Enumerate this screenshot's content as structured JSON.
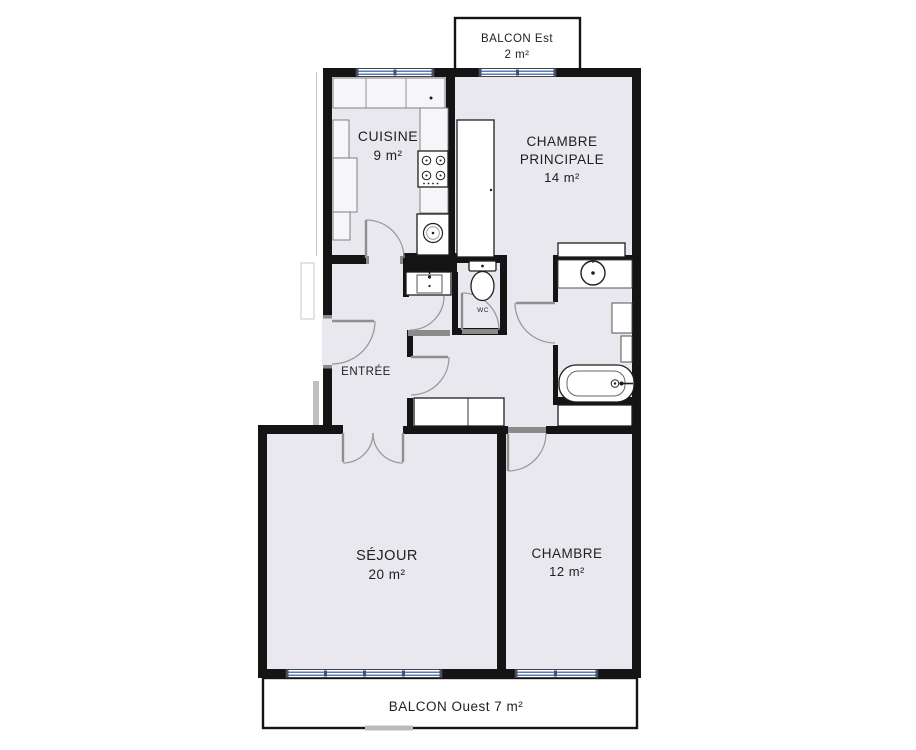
{
  "colors": {
    "background": "#ffffff",
    "room_fill": "#e8e8ee",
    "wall": "#141414",
    "window_accent": "#5b79b4",
    "door_arc": "#9a9a9a",
    "label_text": "#1f1f1f"
  },
  "rooms": {
    "balcony_east": {
      "name": "BALCON Est",
      "area": "2 m²"
    },
    "kitchen": {
      "name": "CUISINE",
      "area": "9 m²"
    },
    "master_bedroom": {
      "name_line1": "CHAMBRE",
      "name_line2": "PRINCIPALE",
      "area": "14 m²"
    },
    "entry": {
      "name": "ENTRÉE"
    },
    "toilet": {
      "name": "WC"
    },
    "living_room": {
      "name": "SÉJOUR",
      "area": "20 m²"
    },
    "bedroom": {
      "name": "CHAMBRE",
      "area": "12 m²"
    },
    "balcony_west": {
      "name": "BALCON Ouest 7 m²"
    }
  }
}
